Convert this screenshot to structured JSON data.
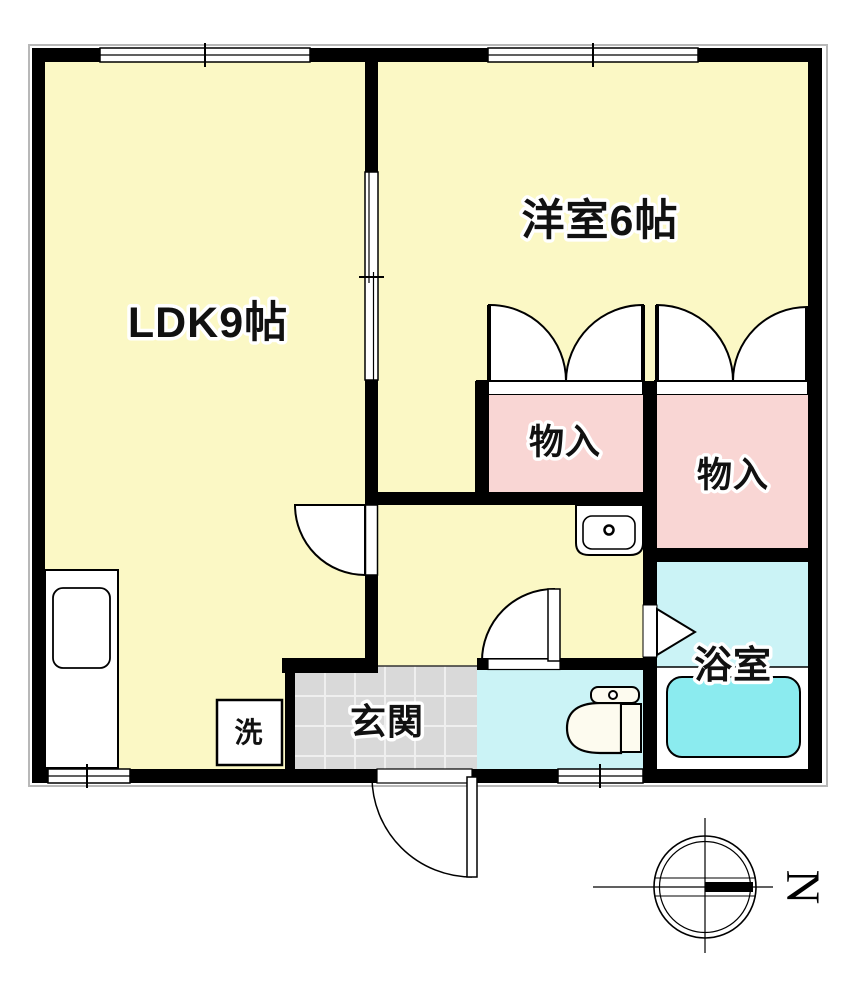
{
  "plan": {
    "rooms": {
      "ldk": {
        "label": "LDK9帖"
      },
      "western_room": {
        "label": "洋室6帖"
      },
      "closet_left": {
        "label": "物入"
      },
      "closet_right": {
        "label": "物入"
      },
      "entrance": {
        "label": "玄関"
      },
      "bathroom": {
        "label": "浴室"
      },
      "laundry": {
        "label": "洗"
      }
    },
    "compass": {
      "north_label": "N"
    },
    "colors": {
      "wall": "#000000",
      "room_yellow": "#FBF8C5",
      "closet_pink": "#F9D6D4",
      "wet_area_cyan": "#CBF3F6",
      "bathtub_cyan": "#8BEBEF",
      "entrance_tile_gray": "#D9D9D9",
      "tile_grid_line": "#EFEFEF"
    }
  }
}
